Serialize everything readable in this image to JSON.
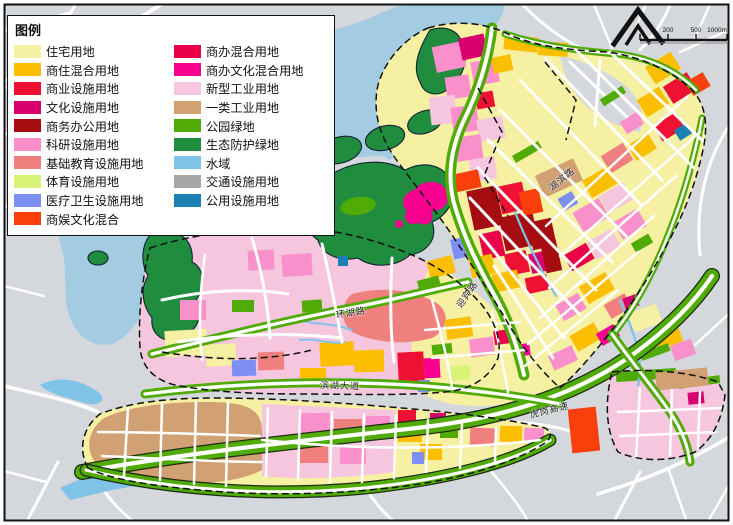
{
  "legend": {
    "title": "图例",
    "items_left": [
      {
        "label": "住宅用地",
        "color": "res"
      },
      {
        "label": "商住混合用地",
        "color": "commres"
      },
      {
        "label": "商业设施用地",
        "color": "comm"
      },
      {
        "label": "文化设施用地",
        "color": "cult"
      },
      {
        "label": "商务办公用地",
        "color": "busoff"
      },
      {
        "label": "科研设施用地",
        "color": "research"
      },
      {
        "label": "基础教育设施用地",
        "color": "edu"
      },
      {
        "label": "体育设施用地",
        "color": "sports"
      },
      {
        "label": "医疗卫生设施用地",
        "color": "medical"
      },
      {
        "label": "商娱文化混合",
        "color": "coment"
      }
    ],
    "items_right": [
      {
        "label": "商办混合用地",
        "color": "comix"
      },
      {
        "label": "商办文化混合用地",
        "color": "cocult"
      },
      {
        "label": "新型工业用地",
        "color": "newind"
      },
      {
        "label": "一类工业用地",
        "color": "ind1"
      },
      {
        "label": "公园绿地",
        "color": "park"
      },
      {
        "label": "生态防护绿地",
        "color": "eco"
      },
      {
        "label": "水域",
        "color": "water"
      },
      {
        "label": "交通设施用地",
        "color": "trans"
      },
      {
        "label": "公用设施用地",
        "color": "util"
      }
    ]
  },
  "map": {
    "labels": [
      {
        "text": "湖滨路"
      },
      {
        "text": "迎宾路"
      },
      {
        "text": "环湖路"
      },
      {
        "text": "滨湖大道"
      },
      {
        "text": "虎岗高速"
      }
    ],
    "scale": {
      "t0": "200",
      "t1": "500",
      "t2": "1000m"
    }
  },
  "colors": {
    "res": "#F6F0A2",
    "commres": "#FBBE00",
    "comm": "#EE1133",
    "cult": "#D8006F",
    "busoff": "#A50D12",
    "research": "#F98FCB",
    "edu": "#F0807E",
    "sports": "#D8F377",
    "medical": "#7D8FF2",
    "coment": "#FA3E0C",
    "comix": "#E90048",
    "cocult": "#F70090",
    "newind": "#F5C6DD",
    "ind1": "#D1A173",
    "park": "#50AB07",
    "eco": "#1F8C3E",
    "water": "#80C3E8",
    "trans": "#A6A6A6",
    "util": "#1B81B3",
    "bg": "#D4D7DB",
    "road": "#FFFFFF",
    "lake": "#A3CBE2",
    "frame": "#111111"
  }
}
